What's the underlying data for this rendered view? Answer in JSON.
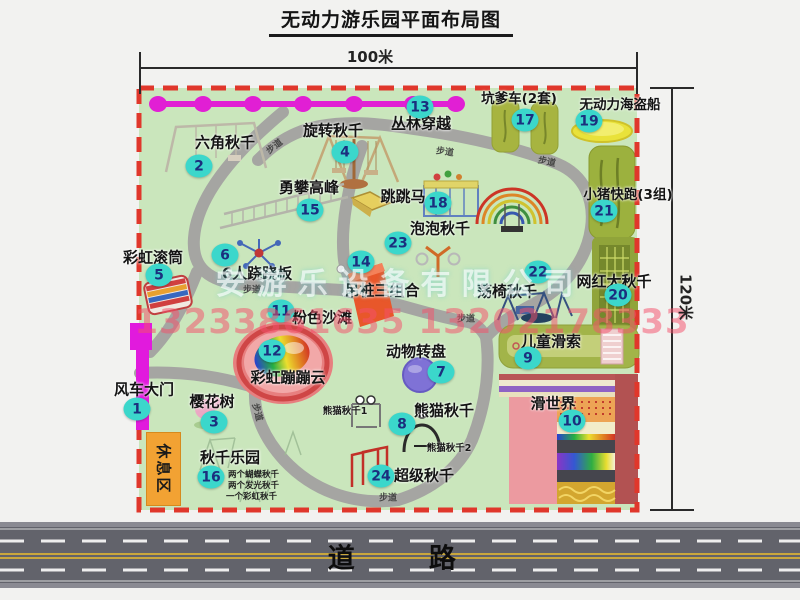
{
  "title": "无动力游乐园平面布局图",
  "dimensions": {
    "width": "100米",
    "height": "120米"
  },
  "road": {
    "label": "道 路"
  },
  "watermark": {
    "company": "安游乐设备有限公司",
    "phone": "13233861635 13202178333"
  },
  "map": {
    "walkway_label": "步道",
    "rest_area_label": "休息区",
    "sub_labels": {
      "panda1": "熊猫秋千1",
      "panda2": "熊猫秋千2"
    },
    "swing_park_notes": [
      "两个蝴蝶秋千",
      "两个发光秋千",
      "一个彩虹秋千"
    ]
  },
  "attractions": [
    {
      "num": "1",
      "name": "风车大门"
    },
    {
      "num": "2",
      "name": "六角秋千"
    },
    {
      "num": "3",
      "name": "樱花树"
    },
    {
      "num": "4",
      "name": "旋转秋千"
    },
    {
      "num": "5",
      "name": "彩虹滚筒"
    },
    {
      "num": "6",
      "name": "6人跷跷板"
    },
    {
      "num": "7",
      "name": "动物转盘"
    },
    {
      "num": "8",
      "name": "熊猫秋千"
    },
    {
      "num": "9",
      "name": "儿童滑索"
    },
    {
      "num": "10",
      "name": "滑世界"
    },
    {
      "num": "11",
      "name": "粉色沙滩"
    },
    {
      "num": "12",
      "name": "彩虹蹦蹦云"
    },
    {
      "num": "13",
      "name": "丛林穿越"
    },
    {
      "num": "14",
      "name": "吊桩三组合"
    },
    {
      "num": "15",
      "name": "勇攀高峰"
    },
    {
      "num": "16",
      "name": "秋千乐园"
    },
    {
      "num": "17",
      "name": "坑爹车(2套)"
    },
    {
      "num": "18",
      "name": "跳跳马"
    },
    {
      "num": "19",
      "name": "无动力海盗船"
    },
    {
      "num": "20",
      "name": "网红大秋千"
    },
    {
      "num": "21",
      "name": "小猪快跑(3组)"
    },
    {
      "num": "22",
      "name": "荡椅秋千"
    },
    {
      "num": "23",
      "name": "泡泡秋千"
    },
    {
      "num": "24",
      "name": "超级秋千"
    }
  ],
  "colors": {
    "park_green": "#cae6bc",
    "border_red": "#e0372b",
    "badge_cyan": "#3bd7cb",
    "path_gray": "#a5a5a2",
    "road_gray": "#62636b",
    "gate_magenta": "#e11add",
    "chain_magenta": "#e11fd4",
    "rest_orange": "#f2a233"
  }
}
